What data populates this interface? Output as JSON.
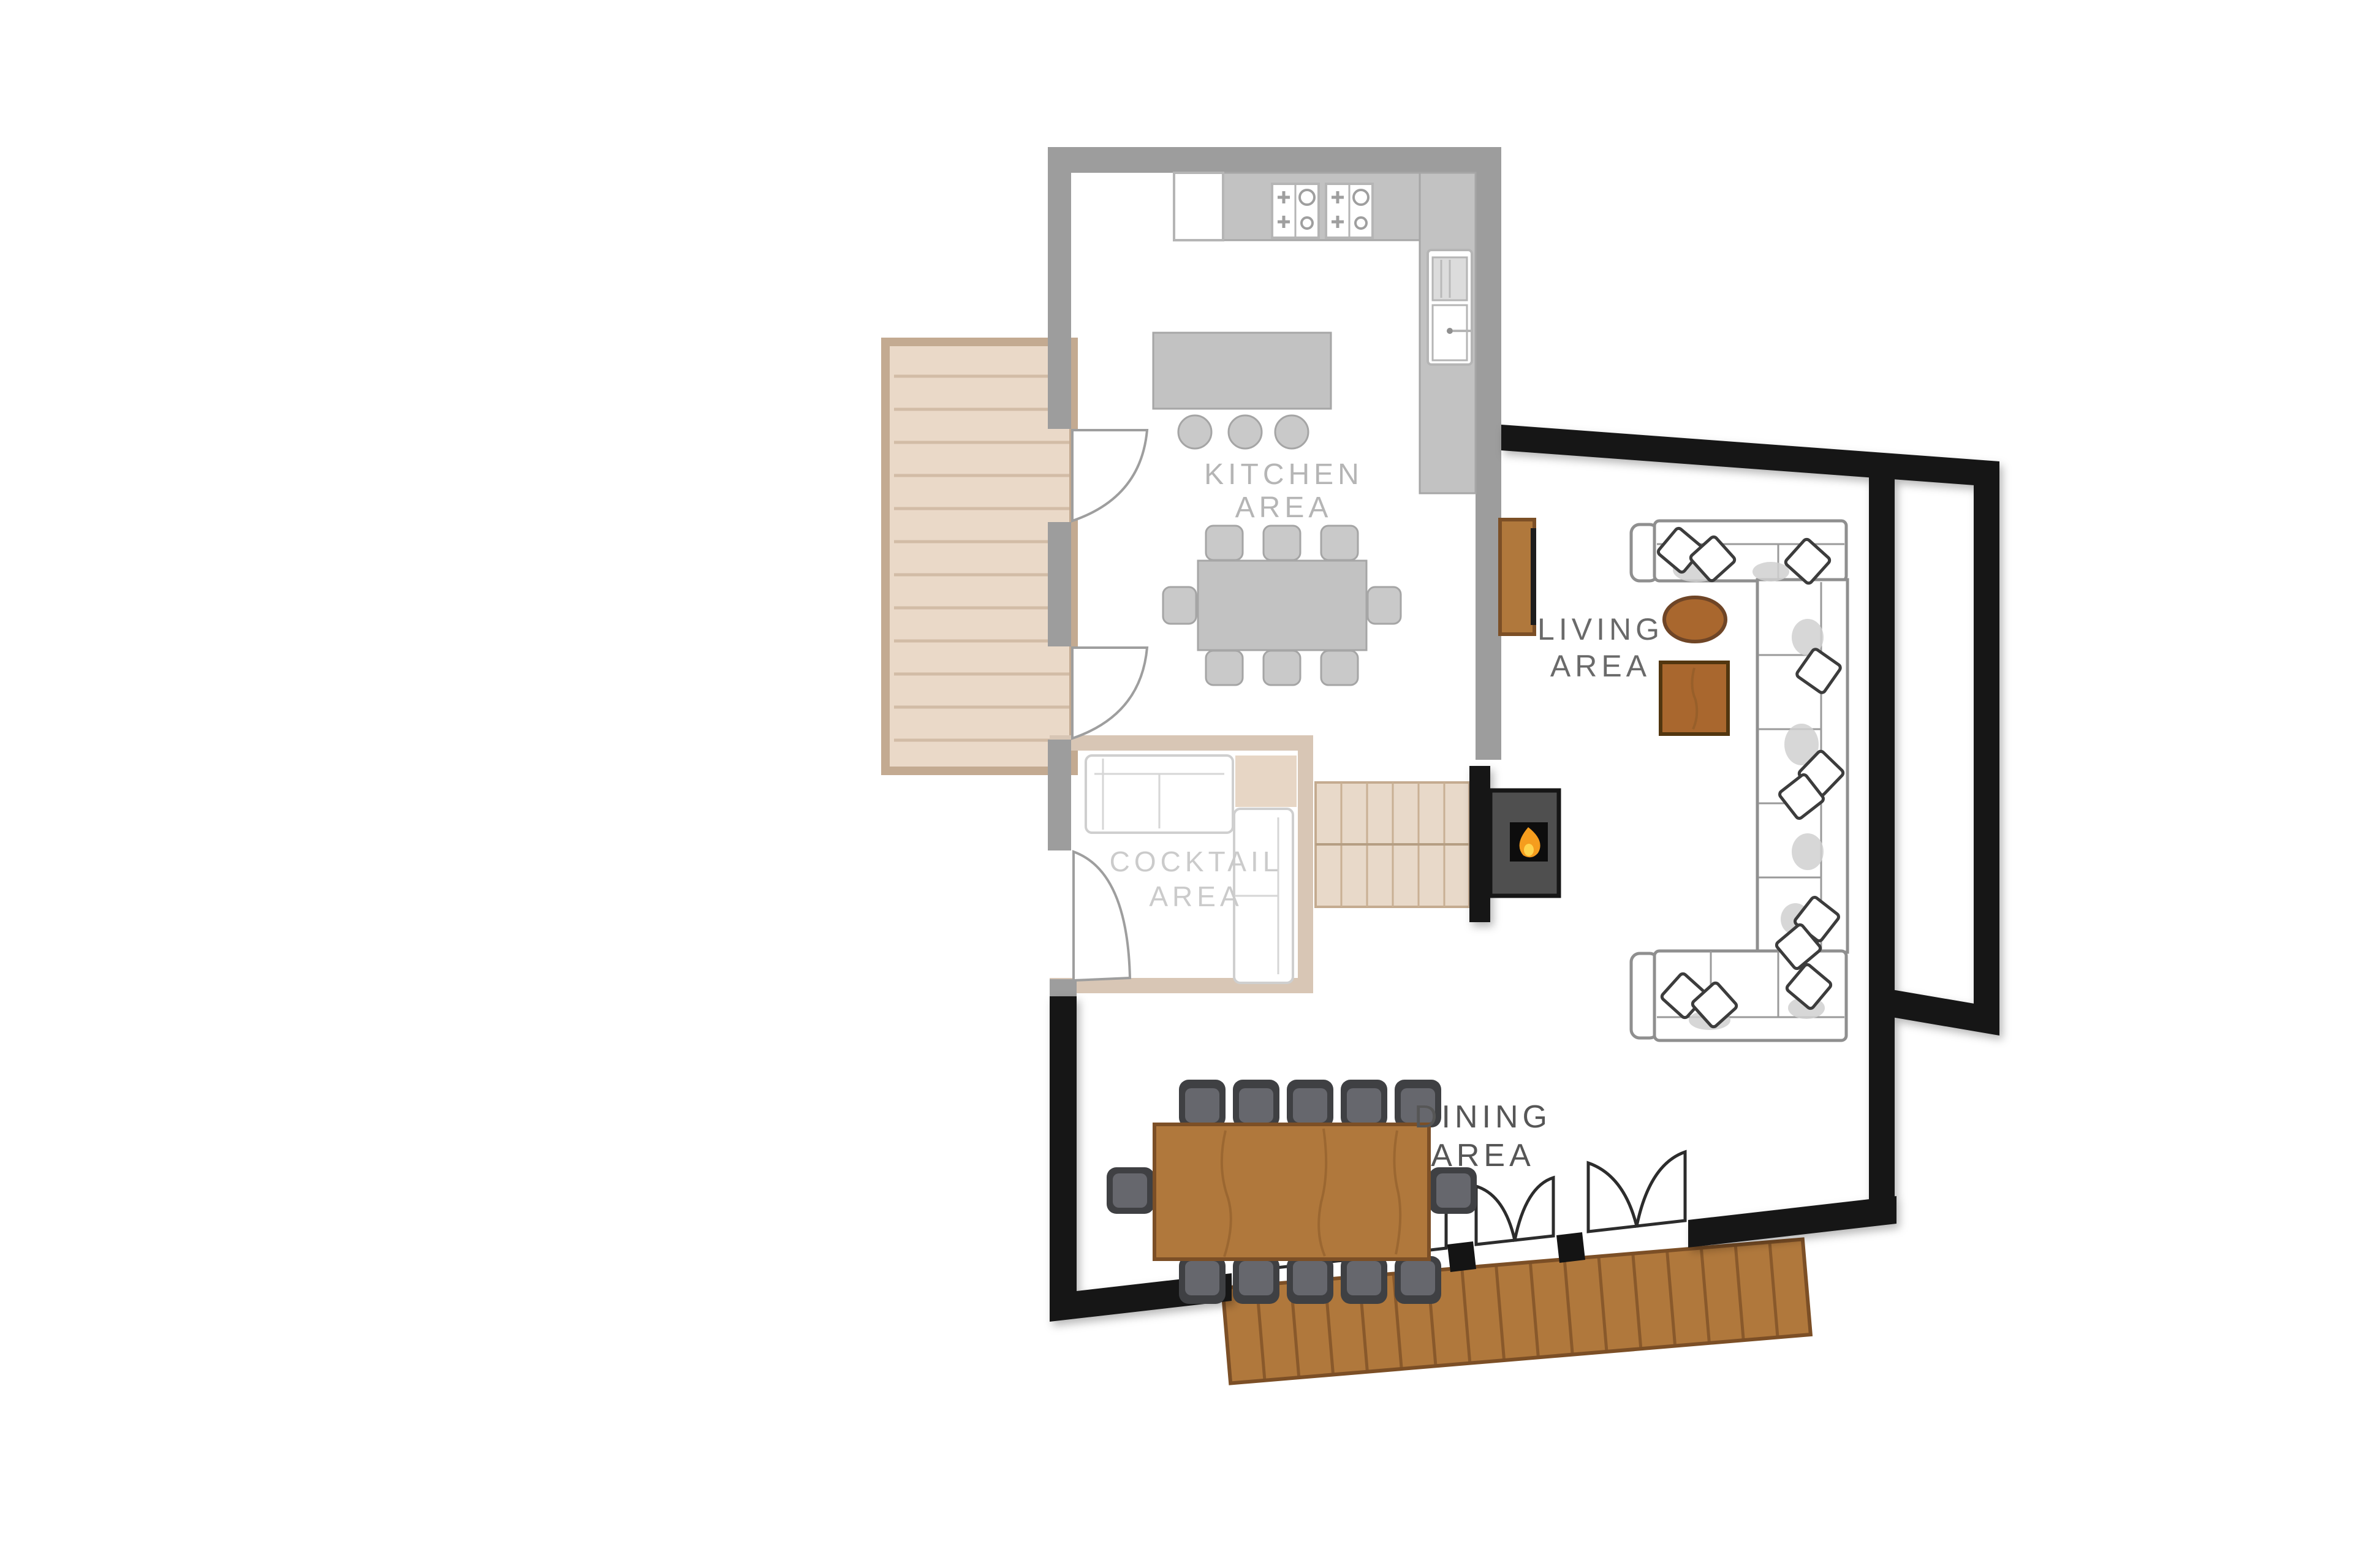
{
  "title": "Chalet main floor plan",
  "areas": {
    "kitchen": {
      "line1": "KITCHEN",
      "line2": "AREA"
    },
    "cocktail": {
      "line1": "COCKTAIL",
      "line2": "AREA"
    },
    "living": {
      "line1": "LIVING",
      "line2": "AREA"
    },
    "dining": {
      "line1": "DINING",
      "line2": "AREA"
    }
  },
  "furniture": {
    "dining_table_seats": 12,
    "kitchen_table_seats": 8,
    "island_stools": 3,
    "hob_burners": 8,
    "patio_door_leaves": 6,
    "decks": 2,
    "fireplace": 1
  },
  "colors": {
    "wall_black": "#141414",
    "ghost_wall": "#9d9d9d",
    "ghost_fill": "#c2c2c2",
    "ghost_light": "#d0d0d0",
    "ghost_text": "#b5b5b5",
    "faint_text": "#cbcbcb",
    "label_text": "#565656",
    "tan_wall": "#d8c6b5",
    "deck_light": "#ead9c8",
    "deck_line": "#d2bca6",
    "deck_border": "#c3aa91",
    "stairs_fill": "#e8d9c9",
    "wood": "#b0783c",
    "wood_dark": "#7c4f26",
    "sofa_line": "#8f8f8f",
    "fireplace_body": "#4f4f4f",
    "flame_orange": "#f59d1e",
    "flame_yellow": "#ffd44d"
  }
}
